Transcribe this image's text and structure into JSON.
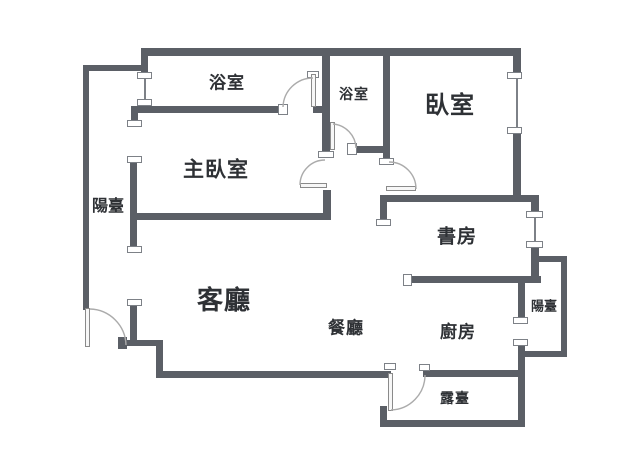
{
  "colors": {
    "wall": "#5b5f66",
    "text": "#2e3135",
    "arc": "#ababab",
    "cap_border": "#7d8187",
    "background": "#ffffff"
  },
  "rooms": {
    "bathroom_top": {
      "label": "浴室"
    },
    "bathroom_mid": {
      "label": "浴室"
    },
    "bedroom": {
      "label": "臥室"
    },
    "master_bedroom": {
      "label": "主臥室"
    },
    "balcony_left": {
      "label": "陽臺"
    },
    "study": {
      "label": "書房"
    },
    "living_room": {
      "label": "客廳"
    },
    "dining_room": {
      "label": "餐廳"
    },
    "kitchen": {
      "label": "廚房"
    },
    "balcony_right": {
      "label": "陽臺"
    },
    "terrace": {
      "label": "露臺"
    }
  }
}
